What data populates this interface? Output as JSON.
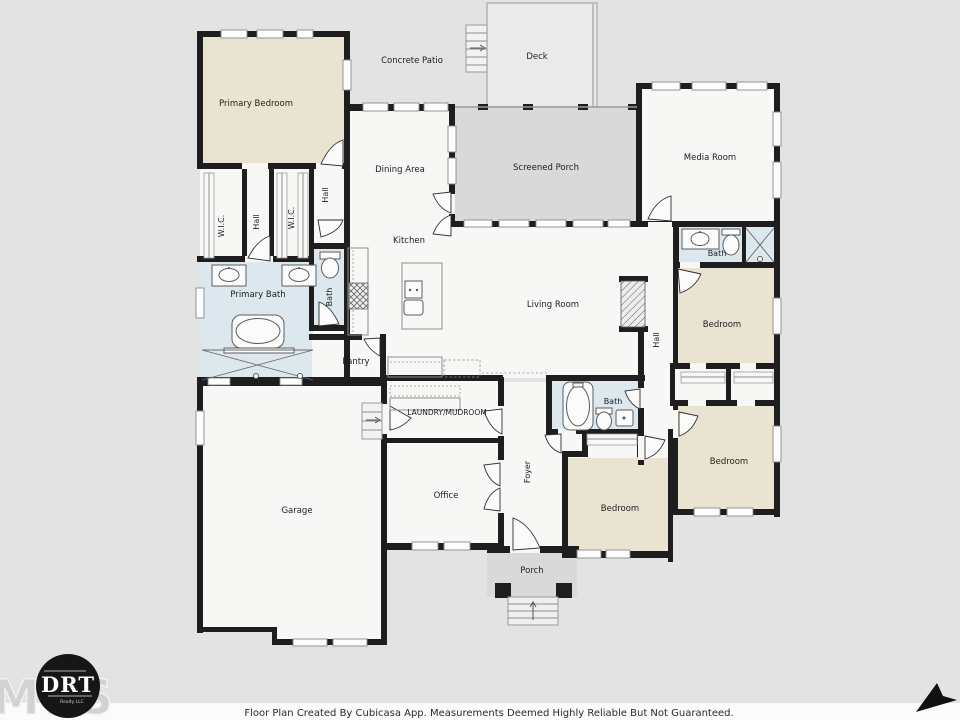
{
  "rooms": {
    "concrete_patio": "Concrete Patio",
    "deck": "Deck",
    "primary_bedroom": "Primary Bedroom",
    "dining_area": "Dining Area",
    "screened_porch": "Screened Porch",
    "media_room": "Media Room",
    "kitchen": "Kitchen",
    "living_room": "Living Room",
    "pantry": "Pantry",
    "primary_bath": "Primary Bath",
    "garage": "Garage",
    "office": "Office",
    "laundry_mudroom": "LAUNDRY/MUDROOM",
    "foyer": "Foyer",
    "porch": "Porch",
    "media_bath": "Bath",
    "hall_bath": "Bath",
    "guest_bath": "Bath",
    "wic_left": "W.I.C.",
    "wic_right": "W.I.C.",
    "hall_closets": "Hall",
    "hall_primary": "Hall",
    "hall_bedrooms": "Hall",
    "bedroom_ne": "Bedroom",
    "bedroom_se": "Bedroom",
    "bedroom_s": "Bedroom"
  },
  "footer": {
    "disclaimer": "Floor Plan Created By Cubicasa App. Measurements Deemed Highly Reliable But Not Guaranteed."
  },
  "branding": {
    "mls_watermark": "MLS",
    "logo_text": "DRT",
    "logo_subtext": "Realty LLC"
  },
  "colors": {
    "background": "#e3e3e3",
    "wall": "#1e1e1e",
    "room_white": "#f7f7f6",
    "bedroom_beige": "#e9e4d1",
    "bath_blue": "#dce8ee",
    "porch_gray": "#d9d9d9",
    "deck_gray": "#eaeaea",
    "footer_bg": "#fbfbfb"
  }
}
